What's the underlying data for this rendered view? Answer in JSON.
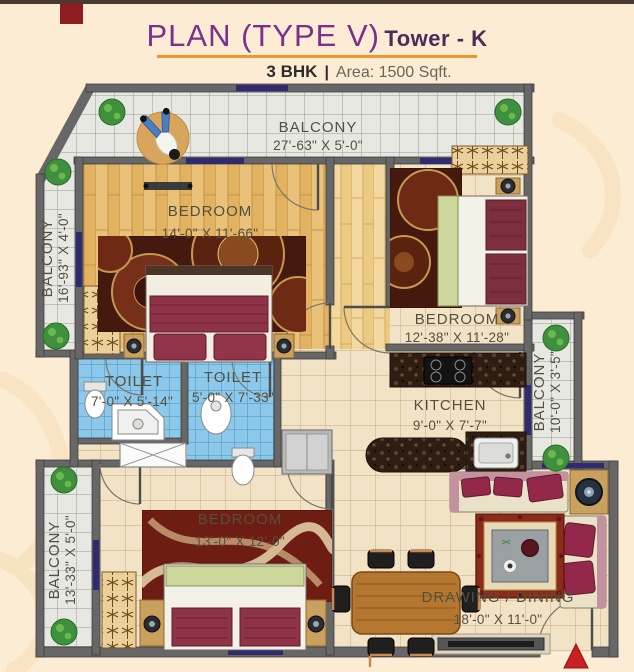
{
  "header": {
    "title": "PLAN (TYPE  V)",
    "tower": "Tower - K",
    "bhk": "3 BHK",
    "separator": "|",
    "area": "Area: 1500 Sqft."
  },
  "rooms": {
    "balcony_top": {
      "name": "BALCONY",
      "dims": "27'-63\" X 5'-0\""
    },
    "balcony_left_upper": {
      "name": "BALCONY",
      "dims": "16'-93\" X 4'-0\""
    },
    "balcony_left_lower": {
      "name": "BALCONY",
      "dims": "13'-33\" X 5'-0\""
    },
    "balcony_right": {
      "name": "BALCONY",
      "dims": "10'-0\" X 3'-5\""
    },
    "bedroom_master": {
      "name": "BEDROOM",
      "dims": "14'-0\" X 11'-66\""
    },
    "bedroom_right": {
      "name": "BEDROOM",
      "dims": "12'-38\" X 11'-28\""
    },
    "bedroom_bottom": {
      "name": "BEDROOM",
      "dims": "13'-0\" X 12'-0\""
    },
    "toilet_left": {
      "name": "TOILET",
      "dims": "7'-0\" X 5'-14\""
    },
    "toilet_right": {
      "name": "TOILET",
      "dims": "5'-0\" X 7'-33\""
    },
    "kitchen": {
      "name": "KITCHEN",
      "dims": "9'-0\" X 7'-7\""
    },
    "drawing_dining": {
      "name": "DRAWING / DINING",
      "dims": "18'-0\" X 11'-0\""
    }
  },
  "colors": {
    "page_bg": "#fcecd3",
    "title_purple": "#7b2f8e",
    "tower_purple": "#4f2a59",
    "underline_orange": "#f0952e",
    "wall_gray": "#676767",
    "tile_blue": "#8cc8e9",
    "wood_floor": "#eac179",
    "cream_tile": "#f2e3c6",
    "balcony_tile": "#e8e8e3",
    "door_navy": "#2f2b70",
    "granite_dark": "#2e1d13",
    "bed_maroon": "#8e3348",
    "plant_green": "#3e8f3e",
    "entry_arrow_red": "#cc1f1f"
  }
}
